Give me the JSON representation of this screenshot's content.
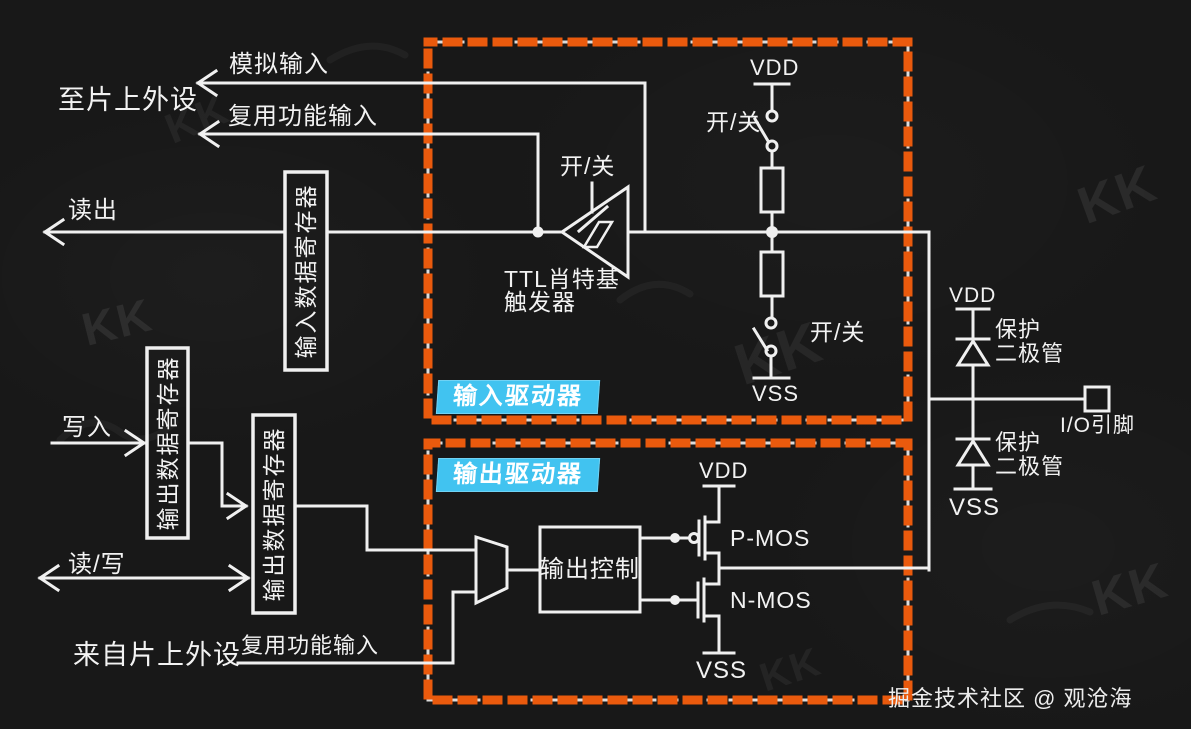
{
  "colors": {
    "background": "#181818",
    "line": "#f0f0f0",
    "dash_orange": "#ea5a0d",
    "tag_background": "#41c3f0",
    "text": "#f2f2f2"
  },
  "peripheral_side": {
    "to_peripheral": "至片上外设",
    "analog_input": "模拟输入",
    "alt_func_input_top": "复用功能输入",
    "readout": "读出",
    "write": "写入",
    "read_write": "读/写",
    "from_peripheral": "来自片上外设",
    "alt_func_input_bottom": "复用功能输入",
    "input_data_register": "输入数据寄存器",
    "output_data_register_upper": "输出数据寄存器",
    "output_data_register_lower": "输出数据寄存器"
  },
  "input_driver": {
    "tag": "输入驱动器",
    "schmitt_trigger_line1": "TTL肖特基",
    "schmitt_trigger_line2": "触发器",
    "schmitt_switch": "开/关",
    "pullup_vdd": "VDD",
    "pullup_switch": "开/关",
    "pulldown_switch": "开/关",
    "pulldown_vss": "VSS"
  },
  "output_driver": {
    "tag": "输出驱动器",
    "output_control": "输出控制",
    "vdd": "VDD",
    "pmos": "P-MOS",
    "nmos": "N-MOS",
    "vss": "VSS"
  },
  "pin_side": {
    "vdd": "VDD",
    "protection_diode_upper_line1": "保护",
    "protection_diode_upper_line2": "二极管",
    "protection_diode_lower_line1": "保护",
    "protection_diode_lower_line2": "二极管",
    "vss": "VSS",
    "io_pin": "I/O引脚"
  },
  "watermark": {
    "logo": "KK",
    "credit": "掘金技术社区 @ 观沧海"
  }
}
